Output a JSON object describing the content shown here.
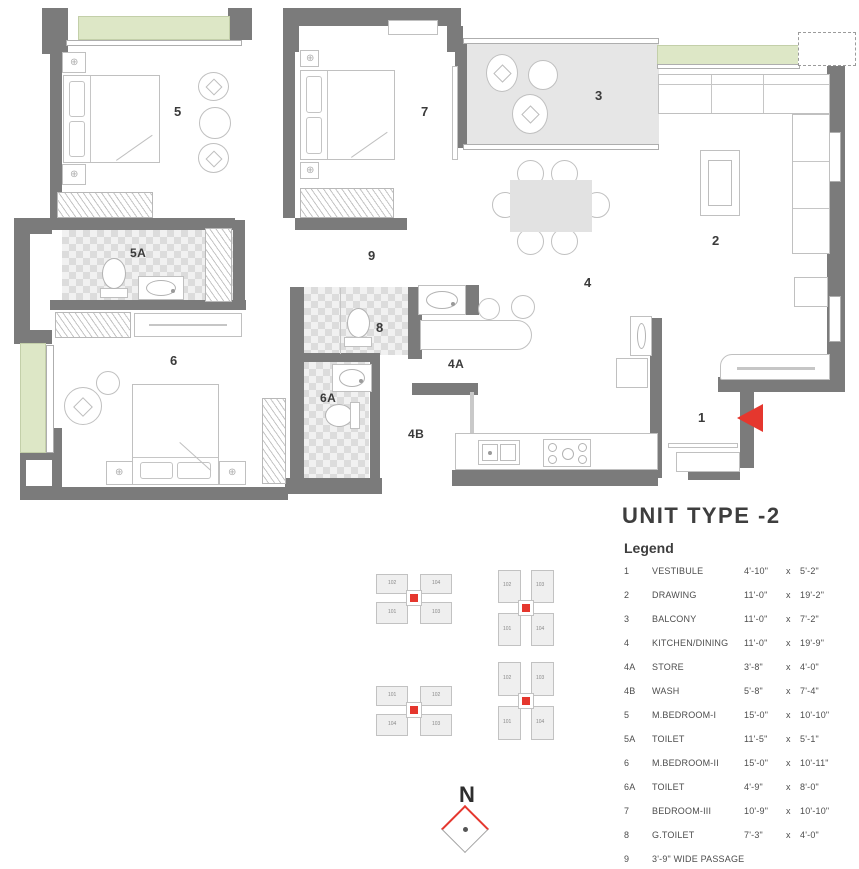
{
  "title": "UNIT TYPE -2",
  "legend": {
    "heading": "Legend",
    "rows": [
      {
        "no": "1",
        "name": "VESTIBULE",
        "dim1": "4'-10\"",
        "sep": "x",
        "dim2": "5'-2\""
      },
      {
        "no": "2",
        "name": "DRAWING",
        "dim1": "11'-0\"",
        "sep": "x",
        "dim2": "19'-2\""
      },
      {
        "no": "3",
        "name": "BALCONY",
        "dim1": "11'-0\"",
        "sep": "x",
        "dim2": "7'-2\""
      },
      {
        "no": "4",
        "name": "KITCHEN/DINING",
        "dim1": "11'-0\"",
        "sep": "x",
        "dim2": "19'-9\""
      },
      {
        "no": "4A",
        "name": "STORE",
        "dim1": "3'-8\"",
        "sep": "x",
        "dim2": "4'-0\""
      },
      {
        "no": "4B",
        "name": "WASH",
        "dim1": "5'-8\"",
        "sep": "x",
        "dim2": "7'-4\""
      },
      {
        "no": "5",
        "name": "M.BEDROOM-I",
        "dim1": "15'-0\"",
        "sep": "x",
        "dim2": "10'-10\""
      },
      {
        "no": "5A",
        "name": "TOILET",
        "dim1": "11'-5\"",
        "sep": "x",
        "dim2": "5'-1\""
      },
      {
        "no": "6",
        "name": "M.BEDROOM-II",
        "dim1": "15'-0\"",
        "sep": "x",
        "dim2": "10'-11\""
      },
      {
        "no": "6A",
        "name": "TOILET",
        "dim1": "4'-9\"",
        "sep": "x",
        "dim2": "8'-0\""
      },
      {
        "no": "7",
        "name": "BEDROOM-III",
        "dim1": "10'-9\"",
        "sep": "x",
        "dim2": "10'-10\""
      },
      {
        "no": "8",
        "name": "G.TOILET",
        "dim1": "7'-3\"",
        "sep": "x",
        "dim2": "4'-0\""
      },
      {
        "no": "9",
        "name": "3'-9\" WIDE PASSAGE",
        "dim1": "",
        "sep": "",
        "dim2": ""
      }
    ]
  },
  "plan": {
    "labels": {
      "r1": "1",
      "r2": "2",
      "r3": "3",
      "r4": "4",
      "r4a": "4A",
      "r4b": "4B",
      "r5": "5",
      "r5a": "5A",
      "r6": "6",
      "r6a": "6A",
      "r7": "7",
      "r8": "8",
      "r9": "9"
    }
  },
  "key_plans": {
    "units": [
      "101",
      "102",
      "103",
      "104"
    ]
  },
  "compass": {
    "label": "N"
  },
  "colors": {
    "wall": "#7b7b7b",
    "green_window": "#dde7c6",
    "toilet_checker": "#dcdcdc",
    "balcony_fill": "#e6e6e6",
    "accent_red": "#e5372e"
  }
}
